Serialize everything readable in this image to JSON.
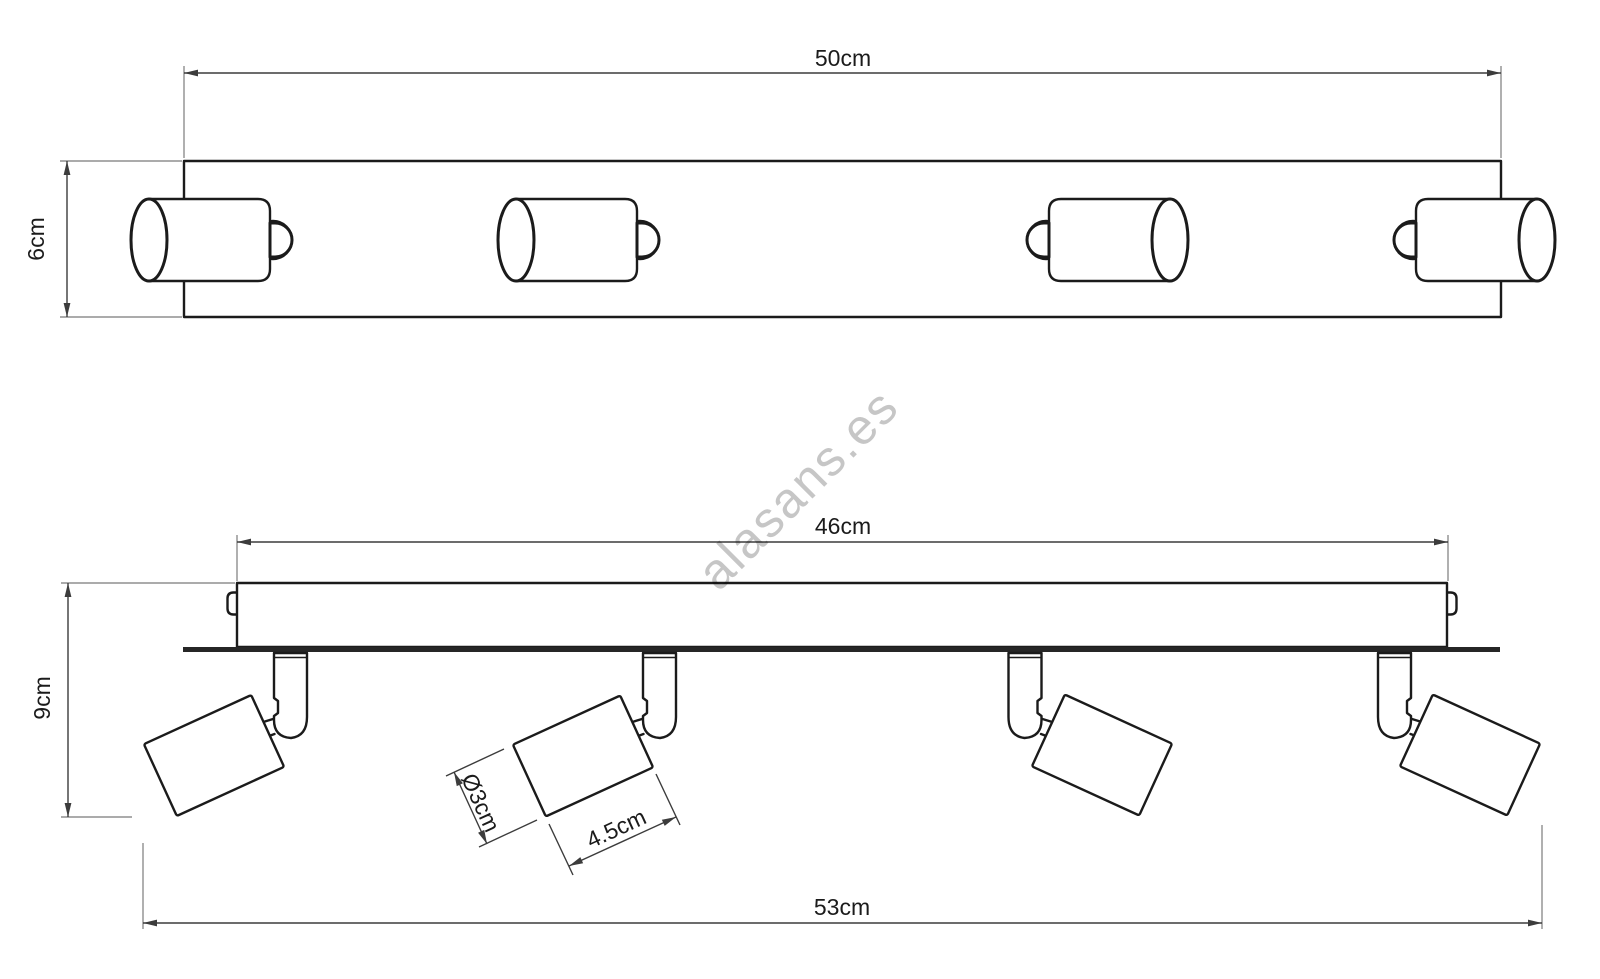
{
  "watermark": {
    "text": "alasans.es"
  },
  "colors": {
    "outline": "#1b1b1b",
    "dimension": "#3c3c3c",
    "extension": "#8f8f8f",
    "watermark": "#c6c6c6",
    "plate": "#262626",
    "label": "#1b1b1b",
    "background": "#ffffff"
  },
  "diagram": {
    "views": [
      "top-view",
      "front-view"
    ],
    "spotlight_count_per_view": 4
  },
  "top_view": {
    "dim_width": "50cm",
    "dim_height": "6cm"
  },
  "front_view": {
    "dim_bar_width": "46cm",
    "dim_height": "9cm",
    "dim_total_width": "53cm",
    "dim_head_diameter": "Ø3cm",
    "dim_head_length": "4.5cm"
  }
}
